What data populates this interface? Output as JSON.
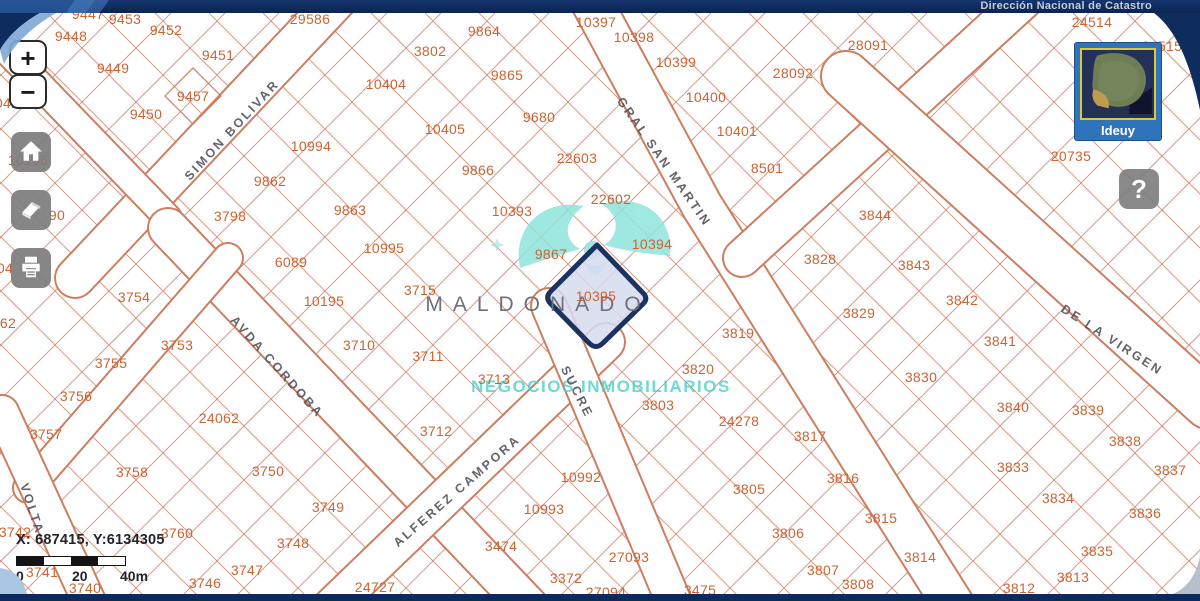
{
  "header": {
    "title": "Dirección Nacional de Catastro"
  },
  "toolbar": {
    "zoom_in_label": "+",
    "zoom_out_label": "−"
  },
  "help_label": "?",
  "minimap": {
    "label": "Ideuy"
  },
  "status": {
    "coordinates": "X: 687415, Y:6134305",
    "scale_labels": [
      "0",
      "20",
      "40m"
    ]
  },
  "watermark": {
    "line1": "MALDONADO",
    "line2": "NEGOCIOS INMOBILIARIOS"
  },
  "colors": {
    "topbar": "#0f2c5f",
    "parcel_text": "#cb6434",
    "parcel_line": "#d0826a",
    "street_text": "#53535c",
    "selected_border": "#1c3260",
    "selected_fill": "#d6dcf0",
    "watermark_teal": "#48d1c8",
    "minimap_frame": "#2f74bb"
  },
  "map": {
    "selected_parcel": "10395",
    "streets": [
      {
        "name": "SIMON BOLIVAR",
        "x": 232,
        "y": 130,
        "rot": -47
      },
      {
        "name": "GRAL SAN MARTIN",
        "x": 664,
        "y": 162,
        "rot": 55
      },
      {
        "name": "AVDA CORDOBA",
        "x": 277,
        "y": 367,
        "rot": 48
      },
      {
        "name": "ALFEREZ CAMPORA",
        "x": 457,
        "y": 491,
        "rot": -41
      },
      {
        "name": "SUCRE",
        "x": 577,
        "y": 392,
        "rot": 63
      },
      {
        "name": "DE LA VIRGEN",
        "x": 1112,
        "y": 340,
        "rot": 33
      },
      {
        "name": "VOLTA",
        "x": 32,
        "y": 509,
        "rot": 72
      }
    ],
    "parcels": [
      {
        "n": "9447",
        "x": 88,
        "y": 14
      },
      {
        "n": "9448",
        "x": 71,
        "y": 36
      },
      {
        "n": "9453",
        "x": 125,
        "y": 19
      },
      {
        "n": "9452",
        "x": 166,
        "y": 30
      },
      {
        "n": "29586",
        "x": 310,
        "y": 19
      },
      {
        "n": "3802",
        "x": 430,
        "y": 51
      },
      {
        "n": "9864",
        "x": 484,
        "y": 31
      },
      {
        "n": "10397",
        "x": 596,
        "y": 22
      },
      {
        "n": "10398",
        "x": 634,
        "y": 37
      },
      {
        "n": "10399",
        "x": 676,
        "y": 62
      },
      {
        "n": "28091",
        "x": 868,
        "y": 45
      },
      {
        "n": "24514",
        "x": 1092,
        "y": 22
      },
      {
        "n": "24515",
        "x": 1162,
        "y": 46
      },
      {
        "n": "9449",
        "x": 113,
        "y": 68
      },
      {
        "n": "9451",
        "x": 218,
        "y": 55
      },
      {
        "n": "9457",
        "x": 193,
        "y": 96
      },
      {
        "n": "10404",
        "x": 386,
        "y": 84
      },
      {
        "n": "9865",
        "x": 507,
        "y": 75
      },
      {
        "n": "10400",
        "x": 706,
        "y": 97
      },
      {
        "n": "28092",
        "x": 793,
        "y": 73
      },
      {
        "n": "9450",
        "x": 146,
        "y": 114
      },
      {
        "n": "0415",
        "x": 11,
        "y": 103
      },
      {
        "n": "10994",
        "x": 311,
        "y": 146
      },
      {
        "n": "10401",
        "x": 737,
        "y": 131
      },
      {
        "n": "8501",
        "x": 767,
        "y": 168
      },
      {
        "n": "10405",
        "x": 445,
        "y": 129
      },
      {
        "n": "9680",
        "x": 539,
        "y": 117
      },
      {
        "n": "22603",
        "x": 577,
        "y": 158
      },
      {
        "n": "20735",
        "x": 1071,
        "y": 156
      },
      {
        "n": "10196",
        "x": 28,
        "y": 160
      },
      {
        "n": "9862",
        "x": 270,
        "y": 181
      },
      {
        "n": "3798",
        "x": 230,
        "y": 216
      },
      {
        "n": "9863",
        "x": 350,
        "y": 210
      },
      {
        "n": "9866",
        "x": 478,
        "y": 170
      },
      {
        "n": "10393",
        "x": 512,
        "y": 211
      },
      {
        "n": "22602",
        "x": 611,
        "y": 199
      },
      {
        "n": "3844",
        "x": 875,
        "y": 215
      },
      {
        "n": "90",
        "x": 57,
        "y": 215
      },
      {
        "n": "10995",
        "x": 384,
        "y": 248
      },
      {
        "n": "9867",
        "x": 551,
        "y": 254
      },
      {
        "n": "10394",
        "x": 652,
        "y": 244
      },
      {
        "n": "3828",
        "x": 820,
        "y": 259
      },
      {
        "n": "3843",
        "x": 914,
        "y": 265
      },
      {
        "n": "6089",
        "x": 291,
        "y": 262
      },
      {
        "n": "04",
        "x": 5,
        "y": 268
      },
      {
        "n": "10195",
        "x": 324,
        "y": 301
      },
      {
        "n": "3715",
        "x": 420,
        "y": 290
      },
      {
        "n": "3754",
        "x": 134,
        "y": 297
      },
      {
        "n": "62",
        "x": 8,
        "y": 323
      },
      {
        "n": "3753",
        "x": 177,
        "y": 345
      },
      {
        "n": "10395",
        "x": 596,
        "y": 296
      },
      {
        "n": "3829",
        "x": 859,
        "y": 313
      },
      {
        "n": "3842",
        "x": 962,
        "y": 300
      },
      {
        "n": "3841",
        "x": 1000,
        "y": 341
      },
      {
        "n": "3710",
        "x": 359,
        "y": 345
      },
      {
        "n": "3711",
        "x": 428,
        "y": 356
      },
      {
        "n": "3755",
        "x": 111,
        "y": 363
      },
      {
        "n": "3819",
        "x": 738,
        "y": 333
      },
      {
        "n": "3756",
        "x": 76,
        "y": 396
      },
      {
        "n": "3713",
        "x": 494,
        "y": 379
      },
      {
        "n": "3820",
        "x": 698,
        "y": 369
      },
      {
        "n": "3830",
        "x": 921,
        "y": 377
      },
      {
        "n": "3840",
        "x": 1013,
        "y": 407
      },
      {
        "n": "3839",
        "x": 1088,
        "y": 410
      },
      {
        "n": "24062",
        "x": 219,
        "y": 418
      },
      {
        "n": "3803",
        "x": 658,
        "y": 405
      },
      {
        "n": "24278",
        "x": 739,
        "y": 421
      },
      {
        "n": "3757",
        "x": 46,
        "y": 434
      },
      {
        "n": "3712",
        "x": 436,
        "y": 431
      },
      {
        "n": "3817",
        "x": 810,
        "y": 436
      },
      {
        "n": "3838",
        "x": 1125,
        "y": 441
      },
      {
        "n": "3758",
        "x": 132,
        "y": 472
      },
      {
        "n": "3750",
        "x": 268,
        "y": 471
      },
      {
        "n": "10992",
        "x": 581,
        "y": 477
      },
      {
        "n": "3805",
        "x": 749,
        "y": 489
      },
      {
        "n": "3816",
        "x": 843,
        "y": 478
      },
      {
        "n": "3833",
        "x": 1013,
        "y": 467
      },
      {
        "n": "3834",
        "x": 1058,
        "y": 498
      },
      {
        "n": "3749",
        "x": 328,
        "y": 507
      },
      {
        "n": "10993",
        "x": 544,
        "y": 509
      },
      {
        "n": "3815",
        "x": 881,
        "y": 518
      },
      {
        "n": "3837",
        "x": 1170,
        "y": 470
      },
      {
        "n": "3836",
        "x": 1145,
        "y": 513
      },
      {
        "n": "3760",
        "x": 177,
        "y": 533
      },
      {
        "n": "3806",
        "x": 788,
        "y": 533
      },
      {
        "n": "3835",
        "x": 1097,
        "y": 551
      },
      {
        "n": "3742",
        "x": 15,
        "y": 532
      },
      {
        "n": "3741",
        "x": 42,
        "y": 572
      },
      {
        "n": "3747",
        "x": 247,
        "y": 570
      },
      {
        "n": "3746",
        "x": 205,
        "y": 583
      },
      {
        "n": "3740",
        "x": 85,
        "y": 588
      },
      {
        "n": "3748",
        "x": 293,
        "y": 543
      },
      {
        "n": "3474",
        "x": 501,
        "y": 546
      },
      {
        "n": "27093",
        "x": 629,
        "y": 557
      },
      {
        "n": "3814",
        "x": 920,
        "y": 557
      },
      {
        "n": "3372",
        "x": 566,
        "y": 578
      },
      {
        "n": "27094",
        "x": 606,
        "y": 592
      },
      {
        "n": "24727",
        "x": 375,
        "y": 587
      },
      {
        "n": "3475",
        "x": 700,
        "y": 590
      },
      {
        "n": "3807",
        "x": 823,
        "y": 570
      },
      {
        "n": "3808",
        "x": 858,
        "y": 584
      },
      {
        "n": "3813",
        "x": 1073,
        "y": 577
      },
      {
        "n": "3812",
        "x": 1019,
        "y": 588
      }
    ]
  }
}
